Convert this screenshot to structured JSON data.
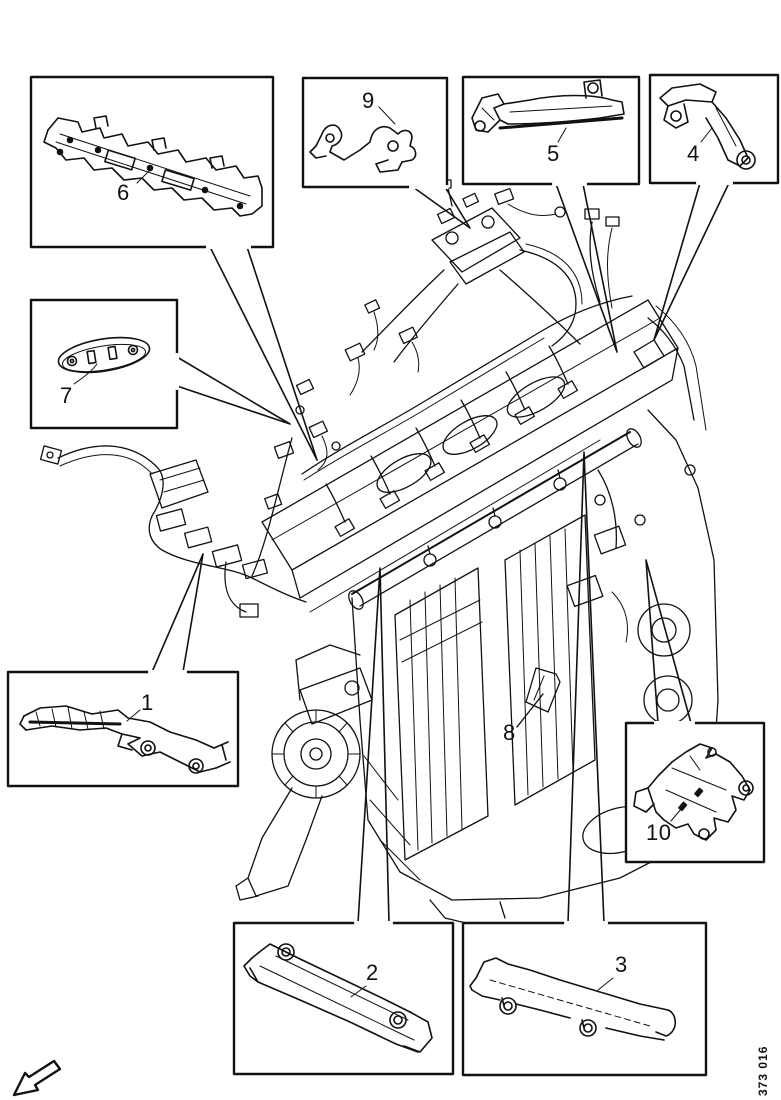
{
  "diagram": {
    "figure_number": "373 016",
    "ink_color": "#111111",
    "paper_color": "#ffffff",
    "callouts": {
      "c1": "1",
      "c2": "2",
      "c3": "3",
      "c4": "4",
      "c5": "5",
      "c6": "6",
      "c7": "7",
      "c8": "8",
      "c9": "9",
      "c10": "10"
    },
    "icons": {
      "front_direction_arrow": "outline-arrow-pointing-lower-left"
    }
  }
}
